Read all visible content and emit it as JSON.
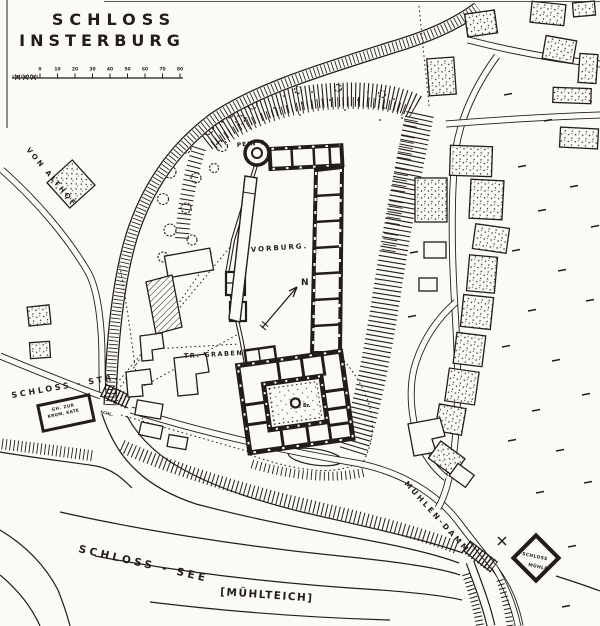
{
  "map": {
    "title": {
      "line1": "SCHLOSS",
      "line2": "INSTERBURG"
    },
    "scale_bar": {
      "zero": "0",
      "ticks": [
        "10",
        "20",
        "30",
        "40",
        "50",
        "60",
        "70",
        "80"
      ]
    },
    "labels": {
      "road_from_althof": "VON ALTHOF",
      "schloss_strasse": "SCHLOSS - STR.",
      "tavern_line1": "GH. ZUR",
      "tavern_line2": "KRUM. KATE",
      "sluice": "SCHL.",
      "pein_tower": "PEIN T.",
      "vorburg": "VORBURG.",
      "trockener_graben": "TR. GRABEN",
      "north": "N",
      "well": "Br.",
      "muehlen_damm": "MÜHLEN-DAMM",
      "schloss_see": "SCHLOSS - SEE",
      "muehlteich": "[MÜHLTEICH]",
      "mill_line1": "SCHLOSS",
      "mill_line2": "MÜHLE"
    },
    "colors": {
      "ink": "#211e1a",
      "paper": "#fbfaf5"
    }
  }
}
